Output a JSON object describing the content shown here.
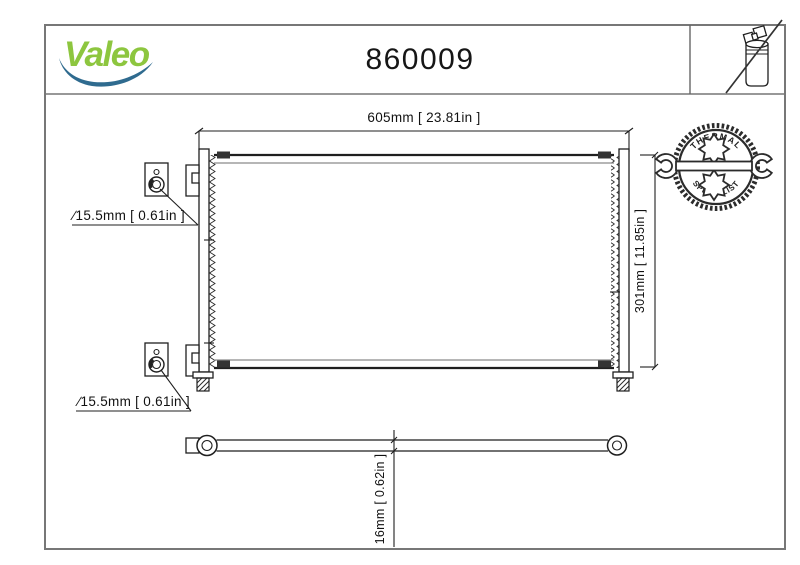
{
  "header": {
    "logo_text": "Valeo",
    "part_number": "860009"
  },
  "badge": {
    "top_text": "THERMAL",
    "bottom_text": "SPECIALIST"
  },
  "drawing": {
    "width_dim": "605mm [ 23.81in ]",
    "height_dim": "301mm [ 11.85in ]",
    "port_dim_top": "∕15.5mm [ 0.61in ]",
    "port_dim_bottom": "∕15.5mm [ 0.61in ]",
    "thickness_dim": "16mm [ 0.62in ]"
  },
  "icons": {
    "brand_swoosh": "valeo-blue-swoosh",
    "no_drier_icon": "receiver-drier-bottle-crossed-out",
    "badge_icon": "wrench-with-gears-stamp"
  },
  "colors": {
    "brand_green": "#8DC63F",
    "swoosh_blue": "#2F6B8F",
    "line_black": "#1f1f1f",
    "line_gray": "#8a8a8a",
    "border_gray": "#777777"
  }
}
